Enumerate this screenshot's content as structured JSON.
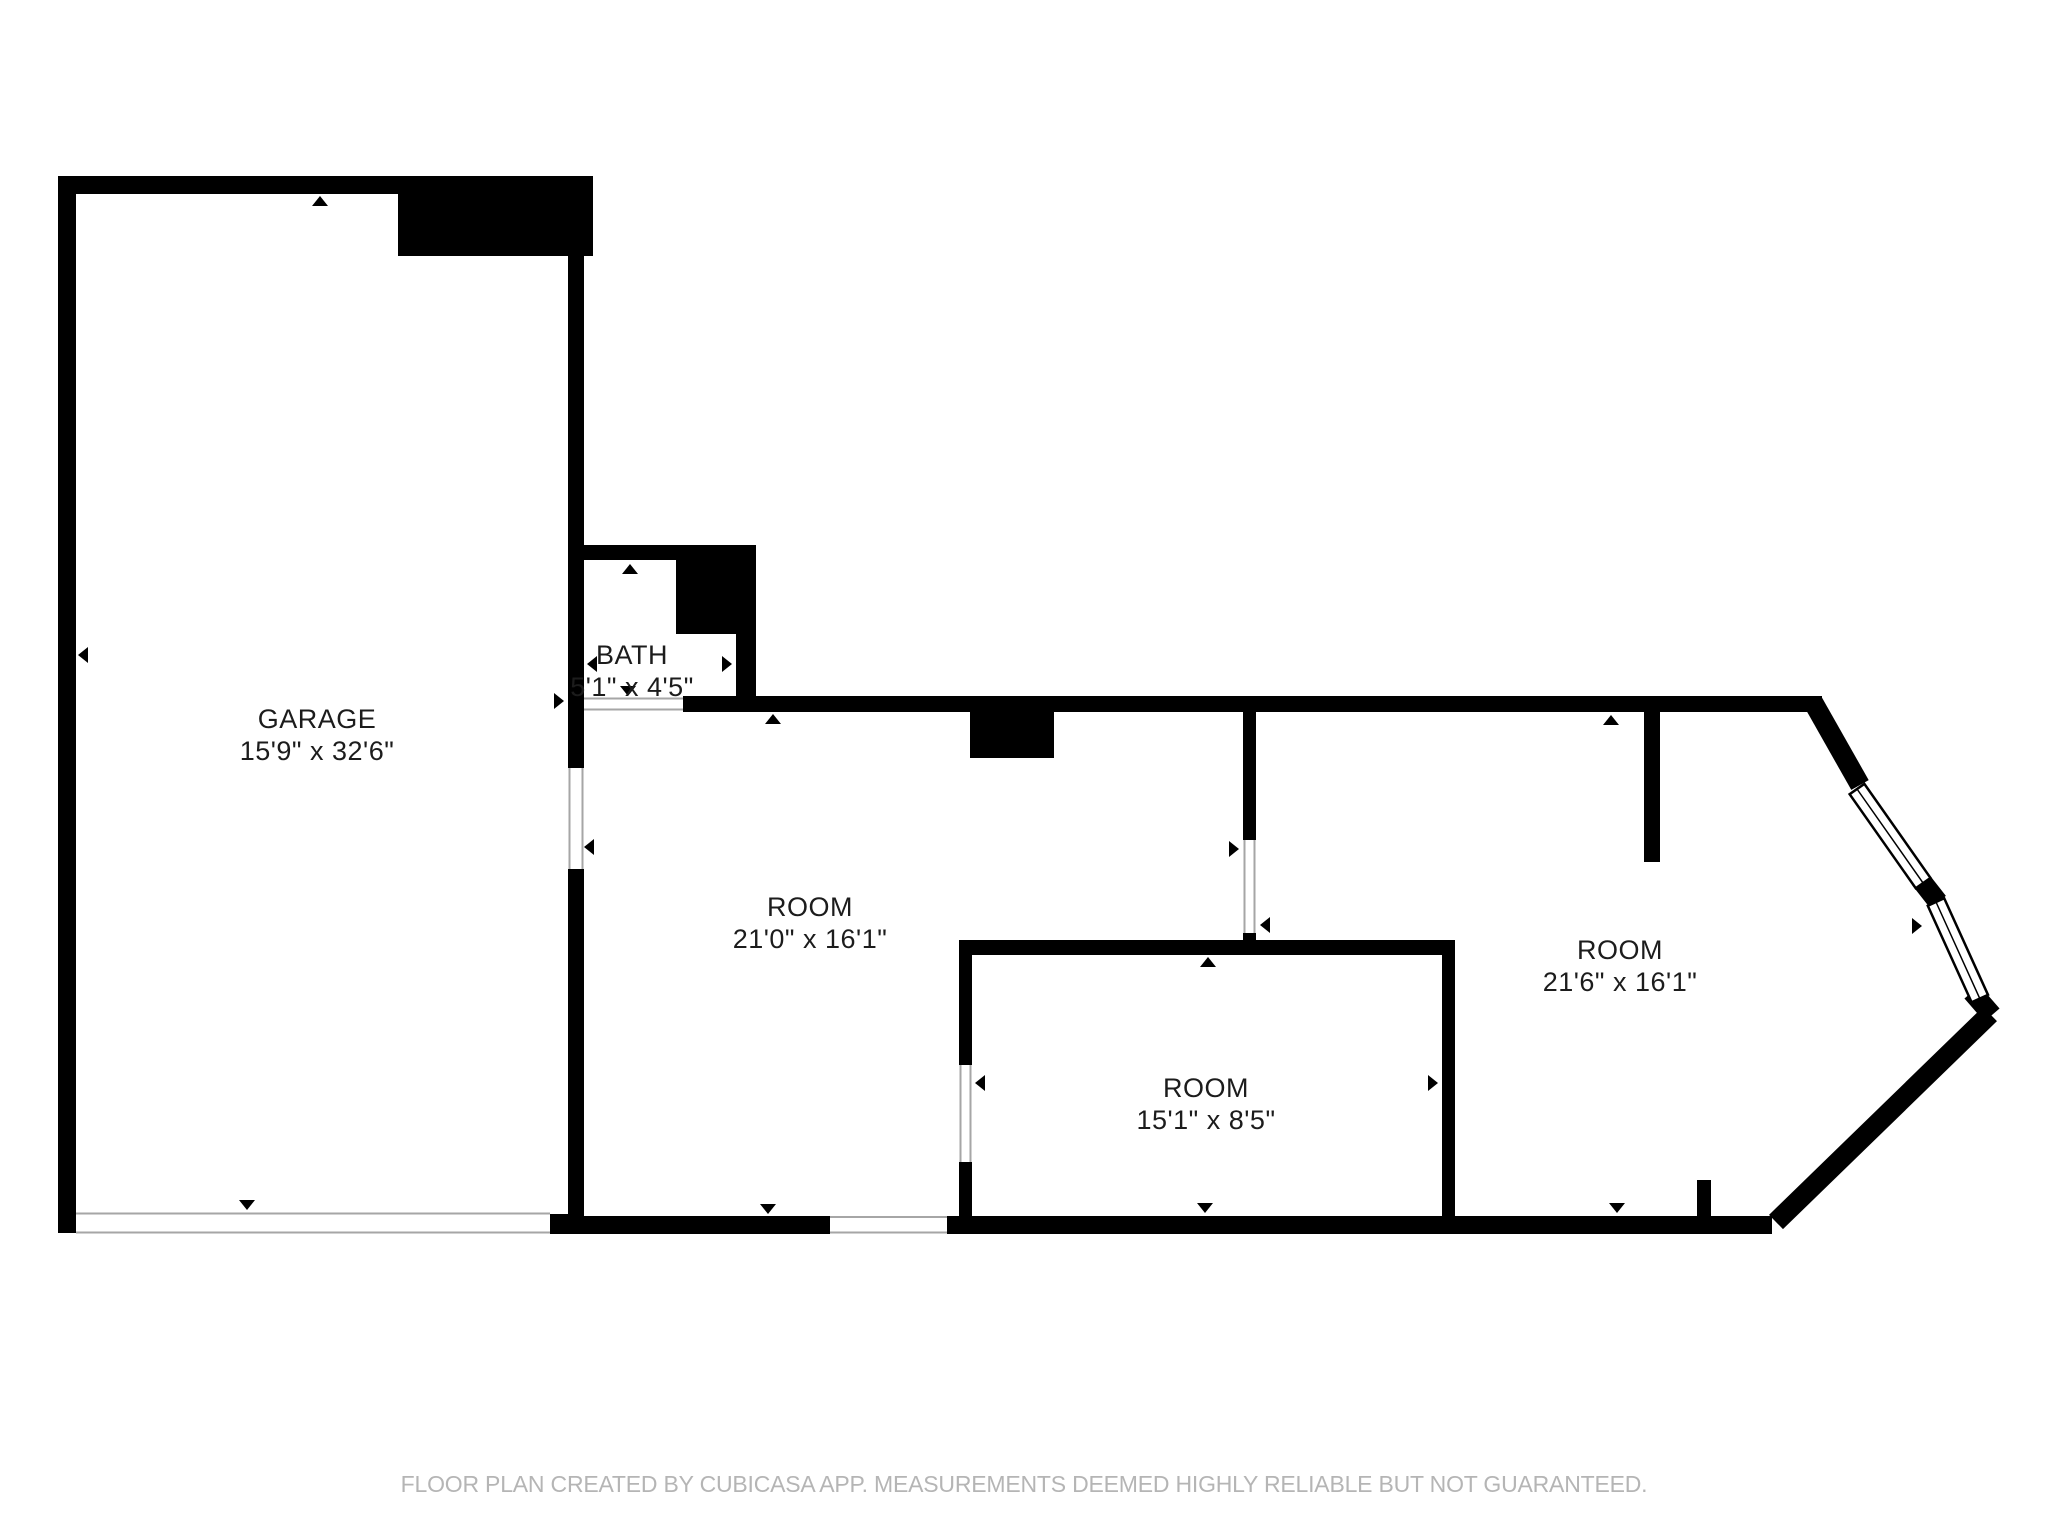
{
  "colors": {
    "wall": "#000000",
    "label": "#1c1c1c",
    "footer": "#b5b5b5",
    "door": "#a6a6a6",
    "background": "#ffffff"
  },
  "rooms": [
    {
      "name": "GARAGE",
      "dimensions": "15'9\" x 32'6\""
    },
    {
      "name": "BATH",
      "dimensions": "5'1\" x 4'5\""
    },
    {
      "name": "ROOM",
      "dimensions": "21'0\" x 16'1\""
    },
    {
      "name": "ROOM",
      "dimensions": "15'1\" x 8'5\""
    },
    {
      "name": "ROOM",
      "dimensions": "21'6\" x 16'1\""
    }
  ],
  "footer": {
    "disclaimer": "FLOOR PLAN CREATED BY CUBICASA APP. MEASUREMENTS DEEMED HIGHLY RELIABLE BUT NOT GUARANTEED."
  }
}
